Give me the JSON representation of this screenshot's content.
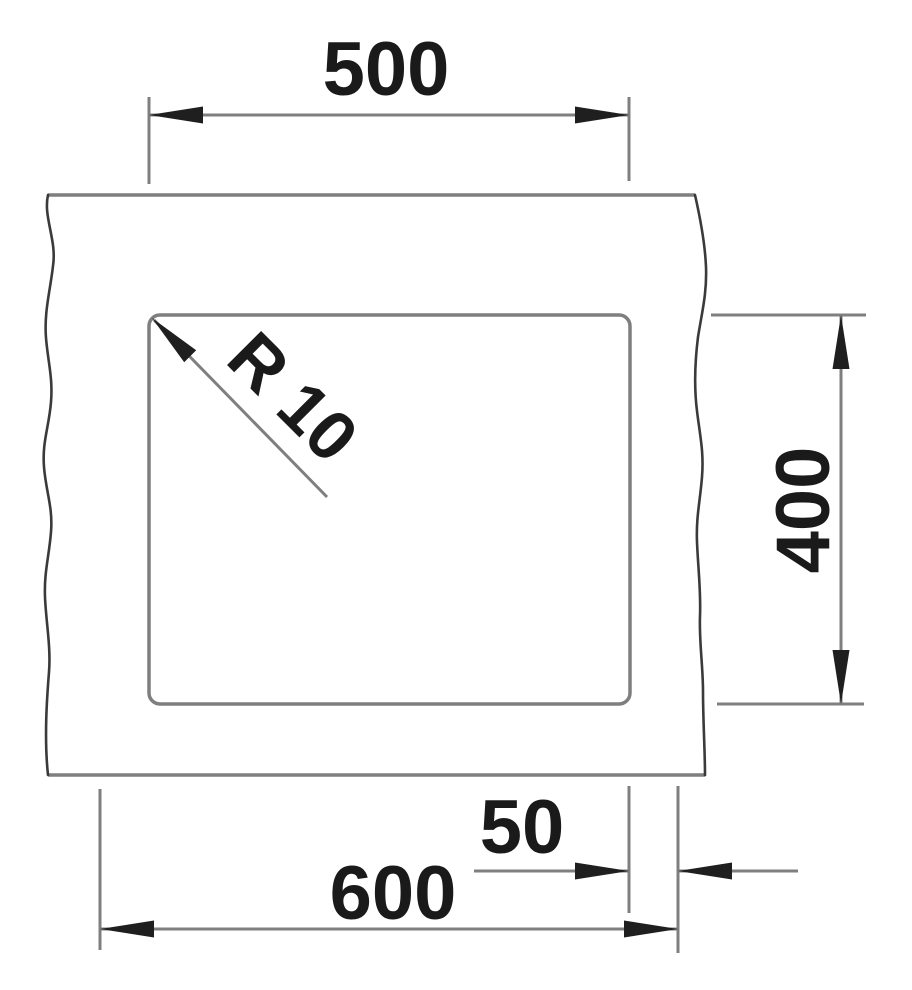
{
  "drawing": {
    "dimensions": {
      "bowl_width": {
        "label": "500"
      },
      "bowl_depth": {
        "label": "400"
      },
      "corner_radius": {
        "label": "R 10"
      },
      "edge_offset": {
        "label": "50"
      },
      "cabinet_width": {
        "label": "600"
      }
    },
    "colors": {
      "line": "#7f7f7f",
      "break_line": "#3a3a3a",
      "ink": "#1a1a1a",
      "background": "#ffffff"
    }
  }
}
